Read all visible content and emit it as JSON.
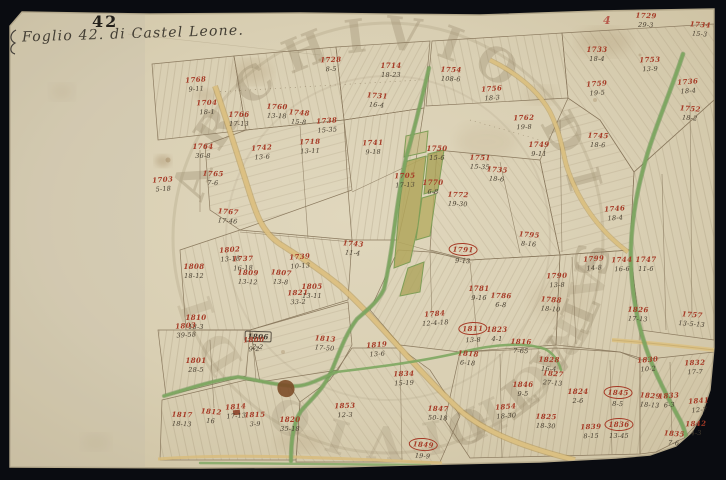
{
  "document": {
    "sheet_title_script": "Foglio 42. di Castel Leone.",
    "sheet_number_stamp": "42",
    "corner_page_stamp": "4",
    "watermark_text": "ARCHIVIO DI STATO"
  },
  "palette": {
    "scan_background": "#0a0c11",
    "paper": "#ddd3b8",
    "paper_edge": "#c4b899",
    "ink_lines": "#84735a",
    "red_ink": "#a63a26",
    "black_ink": "#3c352b",
    "road_tan": "#dcc183",
    "road_green": "#7da761",
    "parcel_olive": "#b2a65c",
    "watermark": "#988a6c",
    "building_brown": "#7c4c28"
  },
  "map": {
    "parcels": [
      {
        "n": "1768",
        "a": "9-11",
        "x": 196,
        "y": 84
      },
      {
        "n": "1704",
        "a": "18-1",
        "x": 207,
        "y": 107
      },
      {
        "n": "1766",
        "a": "17-13",
        "x": 239,
        "y": 119
      },
      {
        "n": "1760",
        "a": "13-18",
        "x": 277,
        "y": 111
      },
      {
        "n": "1748",
        "a": "15-8",
        "x": 299,
        "y": 117
      },
      {
        "n": "1738",
        "a": "15-35",
        "x": 327,
        "y": 125
      },
      {
        "n": "1728",
        "a": "8-5",
        "x": 331,
        "y": 64
      },
      {
        "n": "1714",
        "a": "18-23",
        "x": 391,
        "y": 70
      },
      {
        "n": "1754",
        "a": "108-6",
        "x": 451,
        "y": 74
      },
      {
        "n": "1731",
        "a": "16-4",
        "x": 377,
        "y": 100
      },
      {
        "n": "1756",
        "a": "18-3",
        "x": 492,
        "y": 93
      },
      {
        "n": "1762",
        "a": "19-8",
        "x": 524,
        "y": 122
      },
      {
        "n": "1749",
        "a": "9-11",
        "x": 539,
        "y": 149
      },
      {
        "n": "1745",
        "a": "18-6",
        "x": 598,
        "y": 140
      },
      {
        "n": "1752",
        "a": "18-2",
        "x": 690,
        "y": 113
      },
      {
        "n": "1759",
        "a": "19-5",
        "x": 597,
        "y": 88
      },
      {
        "n": "1753",
        "a": "13-9",
        "x": 650,
        "y": 64
      },
      {
        "n": "1733",
        "a": "18-4",
        "x": 597,
        "y": 54
      },
      {
        "n": "1729",
        "a": "29-3",
        "x": 646,
        "y": 20
      },
      {
        "n": "1734",
        "a": "15-3",
        "x": 700,
        "y": 29
      },
      {
        "n": "1736",
        "a": "18-4",
        "x": 688,
        "y": 86
      },
      {
        "n": "1741",
        "a": "9-18",
        "x": 373,
        "y": 147
      },
      {
        "n": "1764",
        "a": "36-8",
        "x": 203,
        "y": 151
      },
      {
        "n": "1765",
        "a": "7-6",
        "x": 213,
        "y": 178
      },
      {
        "n": "1767",
        "a": "17-46",
        "x": 228,
        "y": 216
      },
      {
        "n": "1703",
        "a": "5-18",
        "x": 163,
        "y": 184
      },
      {
        "n": "1718",
        "a": "13-11",
        "x": 310,
        "y": 146
      },
      {
        "n": "1750",
        "a": "15-6",
        "x": 437,
        "y": 153
      },
      {
        "n": "1751",
        "a": "15-35",
        "x": 480,
        "y": 162
      },
      {
        "n": "1735",
        "a": "18-6",
        "x": 497,
        "y": 174
      },
      {
        "n": "1742",
        "a": "13-6",
        "x": 262,
        "y": 152
      },
      {
        "n": "1705",
        "a": "17-13",
        "x": 405,
        "y": 180
      },
      {
        "n": "1770",
        "a": "6-8",
        "x": 433,
        "y": 187
      },
      {
        "n": "1772",
        "a": "19-30",
        "x": 458,
        "y": 199
      },
      {
        "n": "1743",
        "a": "11-4",
        "x": 353,
        "y": 248
      },
      {
        "n": "1739",
        "a": "10-13",
        "x": 300,
        "y": 261
      },
      {
        "n": "1737",
        "a": "16-18",
        "x": 243,
        "y": 263
      },
      {
        "n": "1808",
        "a": "18-12",
        "x": 194,
        "y": 271
      },
      {
        "n": "1809",
        "a": "13-12",
        "x": 248,
        "y": 277
      },
      {
        "n": "1807",
        "a": "13-8",
        "x": 281,
        "y": 277
      },
      {
        "n": "1802",
        "a": "13-18",
        "x": 230,
        "y": 254
      },
      {
        "n": "1821",
        "a": "33-2",
        "x": 298,
        "y": 297
      },
      {
        "n": "1810",
        "a": "18-3",
        "x": 196,
        "y": 322
      },
      {
        "n": "1806",
        "a": "2-2",
        "x": 258,
        "y": 341,
        "k": true
      },
      {
        "n": "1813",
        "a": "17-50",
        "x": 325,
        "y": 343
      },
      {
        "n": "1819",
        "a": "13-6",
        "x": 377,
        "y": 349
      },
      {
        "n": "1834",
        "a": "15-19",
        "x": 404,
        "y": 378
      },
      {
        "n": "1805",
        "a": "13-11",
        "x": 312,
        "y": 291
      },
      {
        "n": "1791",
        "a": "9-13",
        "x": 463,
        "y": 254,
        "c": true
      },
      {
        "n": "1795",
        "a": "8-16",
        "x": 529,
        "y": 239
      },
      {
        "n": "1799",
        "a": "14-8",
        "x": 594,
        "y": 263
      },
      {
        "n": "1790",
        "a": "13-8",
        "x": 557,
        "y": 280
      },
      {
        "n": "1781",
        "a": "9-16",
        "x": 479,
        "y": 293
      },
      {
        "n": "1786",
        "a": "6-8",
        "x": 501,
        "y": 300
      },
      {
        "n": "1788",
        "a": "18-10",
        "x": 551,
        "y": 304
      },
      {
        "n": "1784",
        "a": "12-4-18",
        "x": 435,
        "y": 318
      },
      {
        "n": "1811",
        "a": "13-8",
        "x": 473,
        "y": 333,
        "c": true
      },
      {
        "n": "1823",
        "a": "4-1",
        "x": 497,
        "y": 334
      },
      {
        "n": "1816",
        "a": "7-65",
        "x": 521,
        "y": 346
      },
      {
        "n": "1818",
        "a": "6-18",
        "x": 468,
        "y": 358
      },
      {
        "n": "1746",
        "a": "18-4",
        "x": 615,
        "y": 213
      },
      {
        "n": "1744",
        "a": "16-6",
        "x": 622,
        "y": 264
      },
      {
        "n": "1747",
        "a": "11-6",
        "x": 646,
        "y": 264
      },
      {
        "n": "1826",
        "a": "17-13",
        "x": 638,
        "y": 314
      },
      {
        "n": "1757",
        "a": "13-5-13",
        "x": 692,
        "y": 319
      },
      {
        "n": "1803",
        "a": "39-58",
        "x": 186,
        "y": 330
      },
      {
        "n": "1800",
        "a": "9-2",
        "x": 254,
        "y": 344
      },
      {
        "n": "1801",
        "a": "28-5",
        "x": 196,
        "y": 365
      },
      {
        "n": "1817",
        "a": "18-13",
        "x": 182,
        "y": 419
      },
      {
        "n": "1812",
        "a": "16",
        "x": 211,
        "y": 416
      },
      {
        "n": "1814",
        "a": "17-13",
        "x": 236,
        "y": 411
      },
      {
        "n": "1815",
        "a": "3-9",
        "x": 255,
        "y": 419
      },
      {
        "n": "1820",
        "a": "35-18",
        "x": 290,
        "y": 424
      },
      {
        "n": "1847",
        "a": "50-18",
        "x": 438,
        "y": 413
      },
      {
        "n": "1849",
        "a": "19-9",
        "x": 423,
        "y": 449,
        "c": true
      },
      {
        "n": "1854",
        "a": "18-30",
        "x": 506,
        "y": 411
      },
      {
        "n": "1853",
        "a": "12-3",
        "x": 345,
        "y": 410
      },
      {
        "n": "1846",
        "a": "9-5",
        "x": 523,
        "y": 389
      },
      {
        "n": "1828",
        "a": "16-4",
        "x": 549,
        "y": 364
      },
      {
        "n": "1827",
        "a": "27-13",
        "x": 553,
        "y": 378
      },
      {
        "n": "1830",
        "a": "10-2",
        "x": 648,
        "y": 364
      },
      {
        "n": "1832",
        "a": "17-7",
        "x": 695,
        "y": 367
      },
      {
        "n": "1824",
        "a": "2-6",
        "x": 578,
        "y": 396
      },
      {
        "n": "1845",
        "a": "8-5",
        "x": 618,
        "y": 397,
        "c": true
      },
      {
        "n": "1829",
        "a": "18-13",
        "x": 650,
        "y": 400
      },
      {
        "n": "1833",
        "a": "6-3",
        "x": 669,
        "y": 400
      },
      {
        "n": "1839",
        "a": "8-15",
        "x": 591,
        "y": 431
      },
      {
        "n": "1836",
        "a": "13-45",
        "x": 619,
        "y": 429,
        "c": true
      },
      {
        "n": "1825",
        "a": "18-30",
        "x": 546,
        "y": 421
      },
      {
        "n": "1835",
        "a": "7-6",
        "x": 674,
        "y": 438
      },
      {
        "n": "1841",
        "a": "12-7",
        "x": 699,
        "y": 405
      },
      {
        "n": "1842",
        "a": "4-3",
        "x": 696,
        "y": 428
      }
    ]
  }
}
